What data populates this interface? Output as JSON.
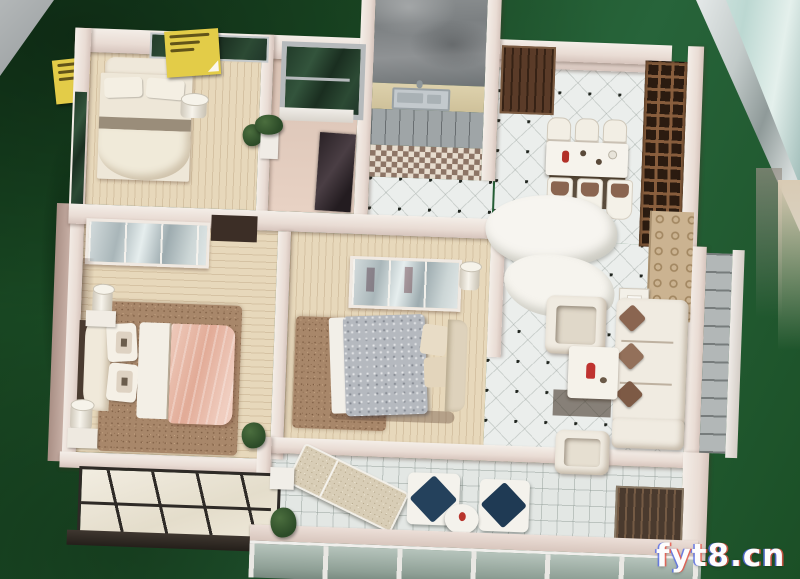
{
  "scene": {
    "type": "photograph",
    "subject": "miniature apartment floor-plan scale model displayed on a green felt table",
    "watermark": {
      "text": "fyt8.cn"
    }
  },
  "colors": {
    "felt_green": "#1d5128",
    "felt_green_dark": "#16421f",
    "wall_light": "#e9dcd4",
    "wall_shade": "#d6c4bc",
    "wood_floor": "#e7d8bb",
    "rug_brown": "#a8876a",
    "tile_white": "#ebeeec",
    "bed_salmon": "#e2ab97",
    "bed_silver": "#b5b9bf",
    "note_yellow": "#e3cc48",
    "lattice_brown": "#8b603e",
    "glass_dark_green": "#223c2a",
    "glass_teal": "#bcd8d2",
    "rail_silver": "#c3cbca",
    "sofa_cream": "#f0ebe1",
    "pillow_brown": "#8a6550",
    "chair_navy": "#24415c",
    "watermark_white": "#fdfdfd"
  }
}
